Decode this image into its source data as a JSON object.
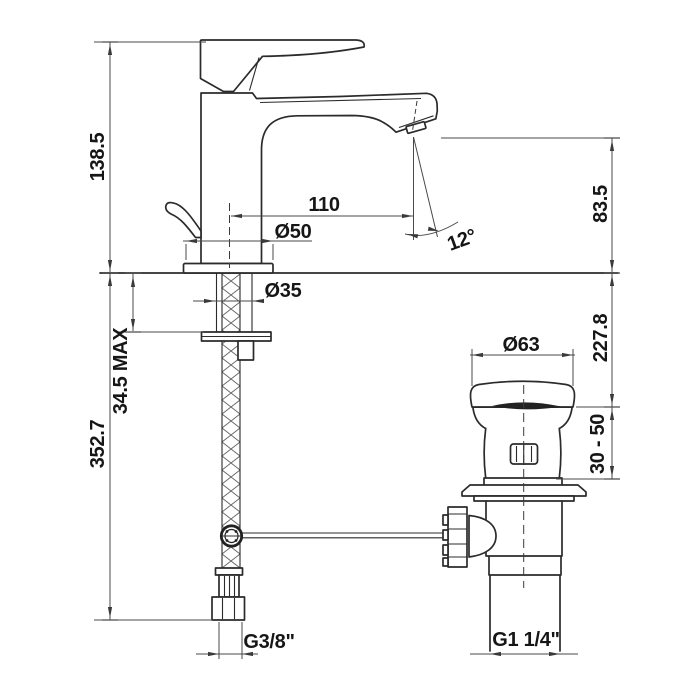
{
  "drawing": {
    "type": "faucet-technical-drawing",
    "background": "#ffffff",
    "line_color": "#2b2b2b",
    "labels": {
      "total_height": "138.5",
      "hose_length": "352.7",
      "deck_max": "34.5 MAX",
      "spout_reach": "110",
      "base_dia": "Ø50",
      "shank_dia": "Ø35",
      "spout_angle": "12°",
      "outlet_height": "83.5",
      "drain_depth": "227.8",
      "drain_range": "30 - 50",
      "cap_dia": "Ø63",
      "supply_thread": "G3/8\"",
      "waste_thread": "G1 1/4\""
    }
  }
}
